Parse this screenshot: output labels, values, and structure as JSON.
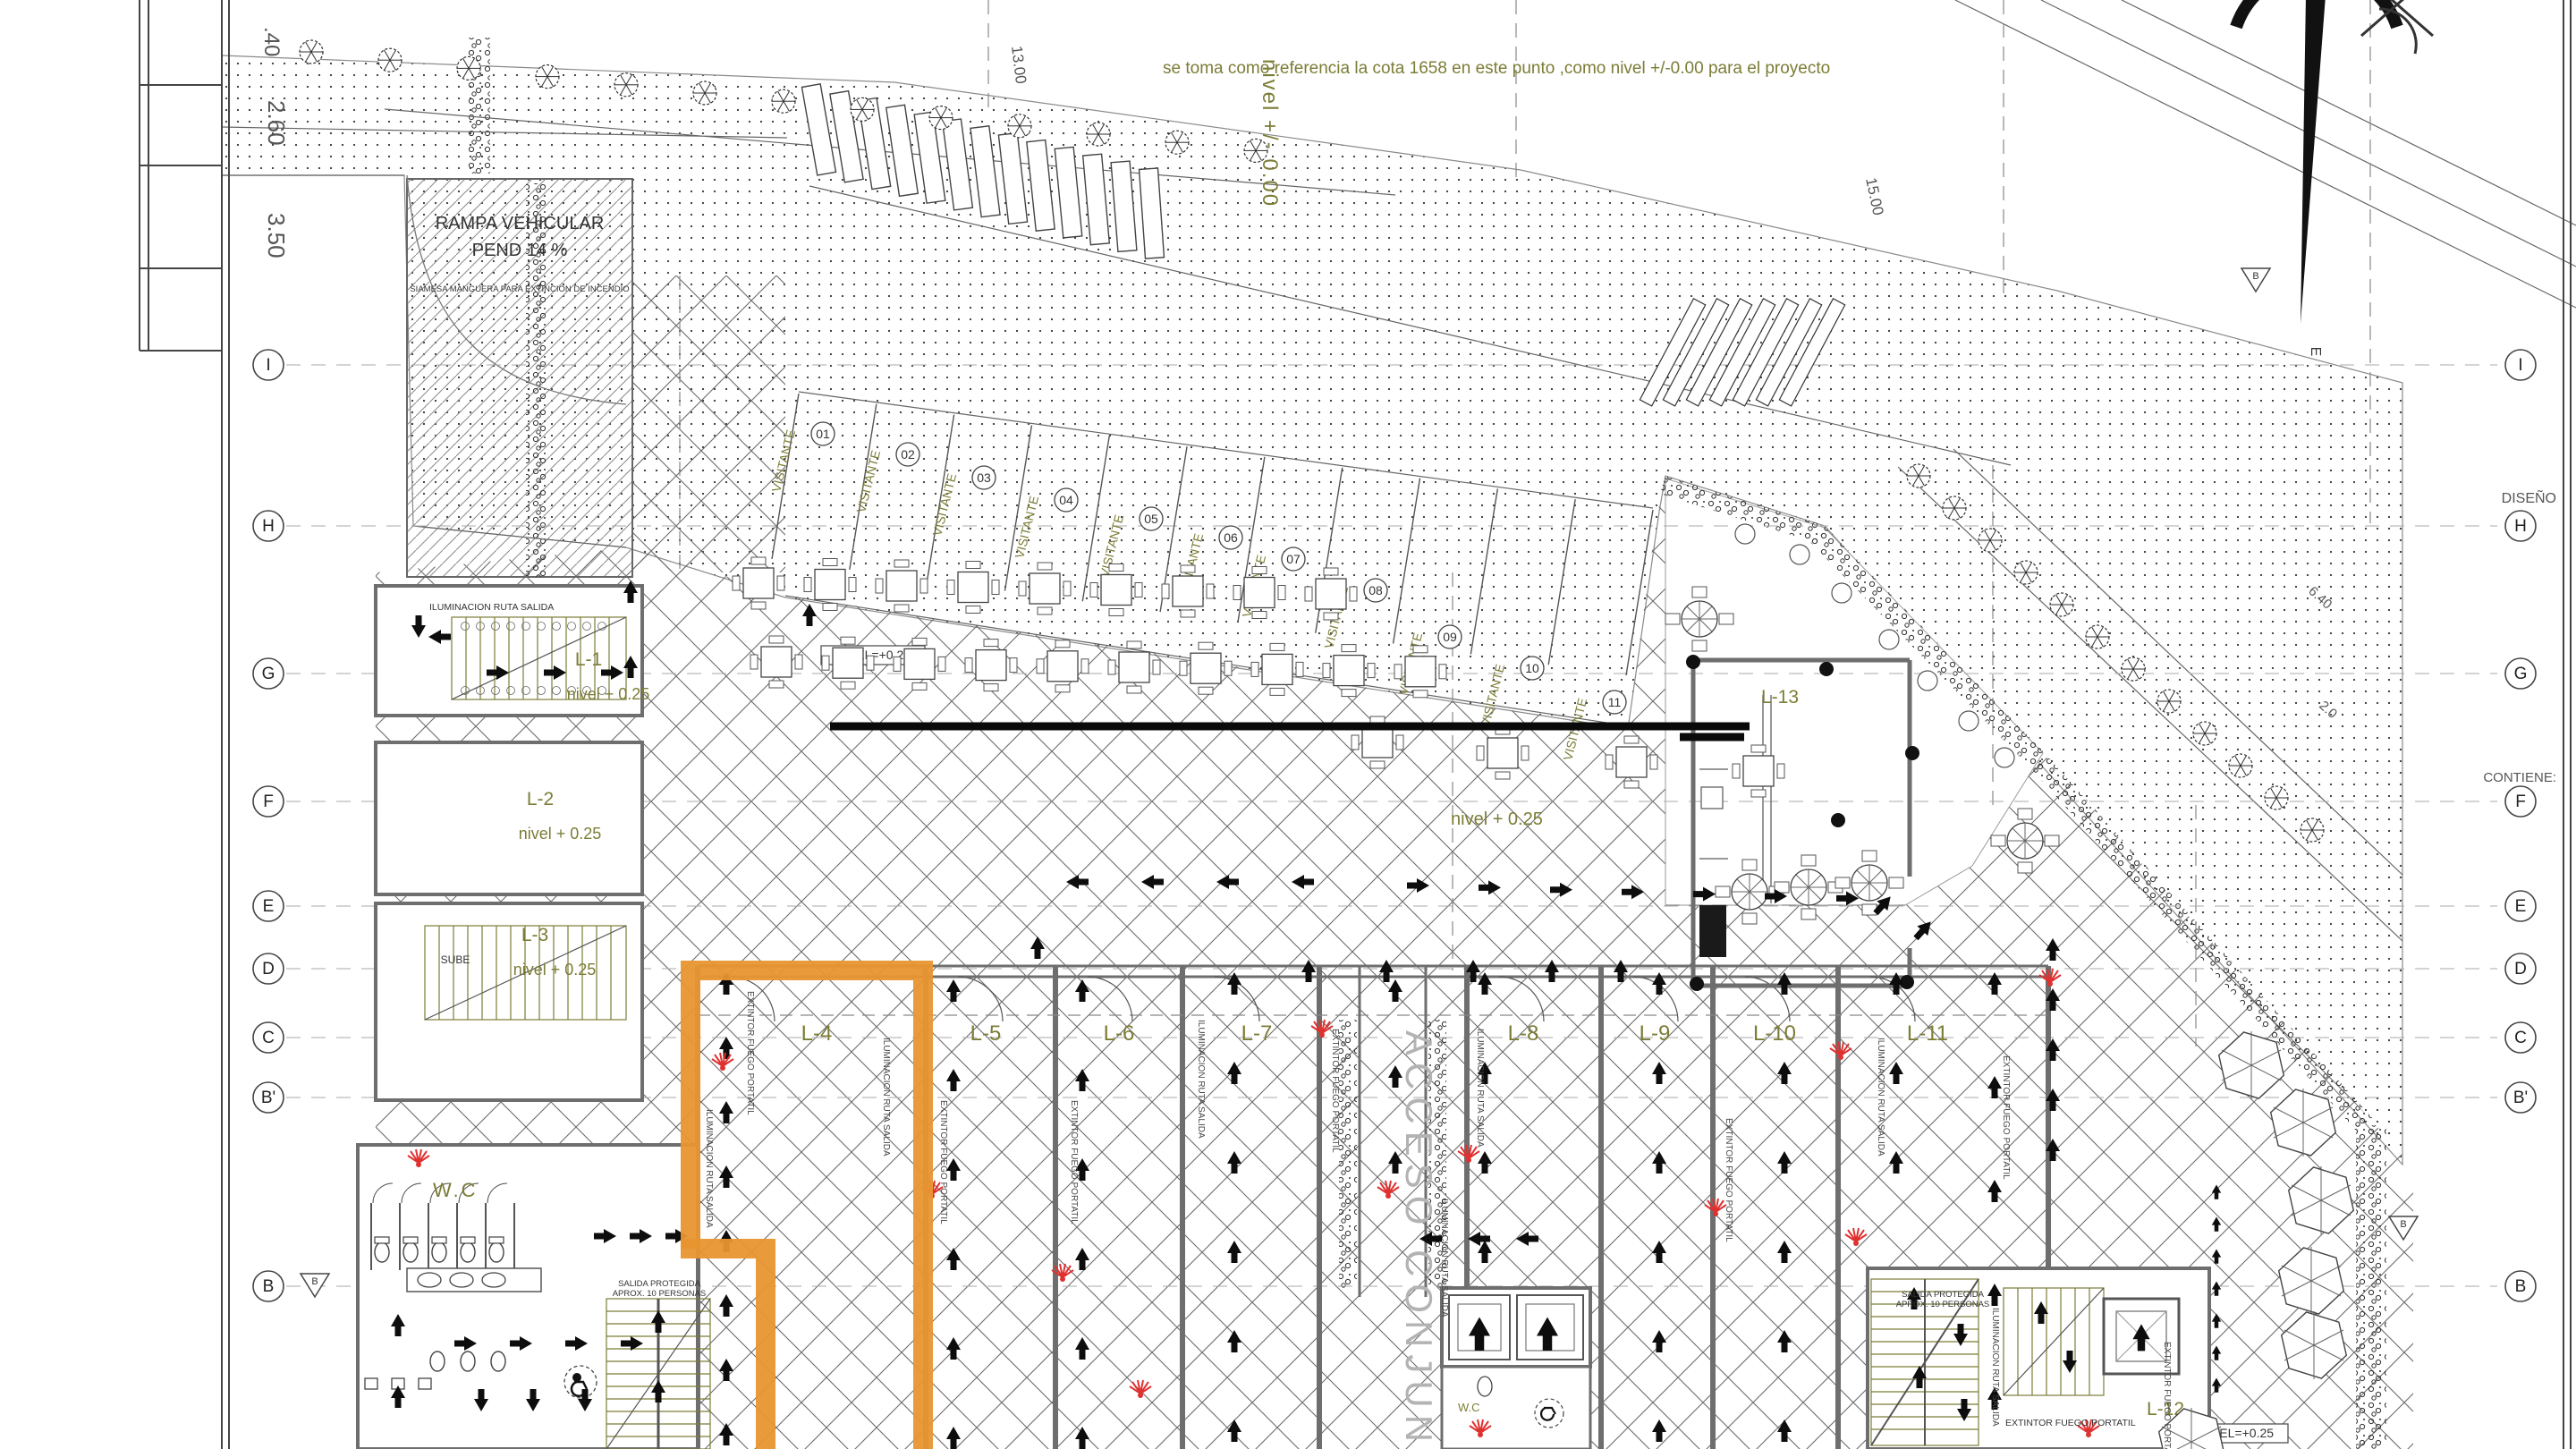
{
  "notes": {
    "reference": "se toma como referencia la cota 1658 en este punto ,como nivel +/-0.00 para el proyecto",
    "datum_vertical": "nivel +/- 0.00"
  },
  "ramp": {
    "line1": "RAMPA VEHICULAR",
    "line2": "PEND 14 %",
    "line3": "SIAMESA MANGUERA PARA EXTINCION DE INCENDIO"
  },
  "margin": {
    "design_label": "DISEÑO",
    "contains_label": "CONTIENE:"
  },
  "grid": {
    "left": [
      "I",
      "H",
      "G",
      "F",
      "E",
      "D",
      "C",
      "B'",
      "B"
    ],
    "right": [
      "I",
      "H",
      "G",
      "F",
      "E",
      "D",
      "C",
      "B'",
      "B"
    ],
    "section_triangle": "B"
  },
  "locales": [
    {
      "id": "L-1",
      "level": "nivel + 0.25"
    },
    {
      "id": "L-2",
      "level": "nivel + 0.25"
    },
    {
      "id": "L-3",
      "level": "nivel + 0.25"
    },
    {
      "id": "L-4"
    },
    {
      "id": "L-5"
    },
    {
      "id": "L-6"
    },
    {
      "id": "L-7"
    },
    {
      "id": "L-8"
    },
    {
      "id": "L-9"
    },
    {
      "id": "L-10"
    },
    {
      "id": "L-11"
    },
    {
      "id": "L-12"
    },
    {
      "id": "L-13"
    }
  ],
  "plaza": {
    "level": "nivel + 0.25",
    "level_box": "NIVEL=+0.25"
  },
  "parking": {
    "stalls": [
      "01",
      "02",
      "03",
      "04",
      "05",
      "06",
      "07",
      "08",
      "09",
      "10",
      "11"
    ],
    "stall_text": "VISITANTE"
  },
  "rooms": {
    "wc": "W.C",
    "stairs_up": "SUBE",
    "corridor": "ACCESO CONJUNTO"
  },
  "safety": {
    "illumination": "ILUMINACION RUTA SALIDA",
    "extinguisher": "EXTINTOR FUEGO PORTATIL",
    "protected_exit_1": "SALIDA PROTEGIDA",
    "protected_exit_2": "APROX. 10 PERSONAS",
    "level_box": "NIVEL=+0.25"
  },
  "dimensions": {
    "top_a": ".40",
    "top_b": "2.60",
    "top_c": "3.50",
    "street_w": "15.00",
    "street_w2": "13.00",
    "diag_a": "6.40",
    "diag_b": "2.0"
  },
  "compass": {
    "east": "E"
  },
  "colors": {
    "olive": "#7b7d36",
    "orange": "#e8952f",
    "red": "#e03131",
    "wall": "#6e6e6e"
  }
}
